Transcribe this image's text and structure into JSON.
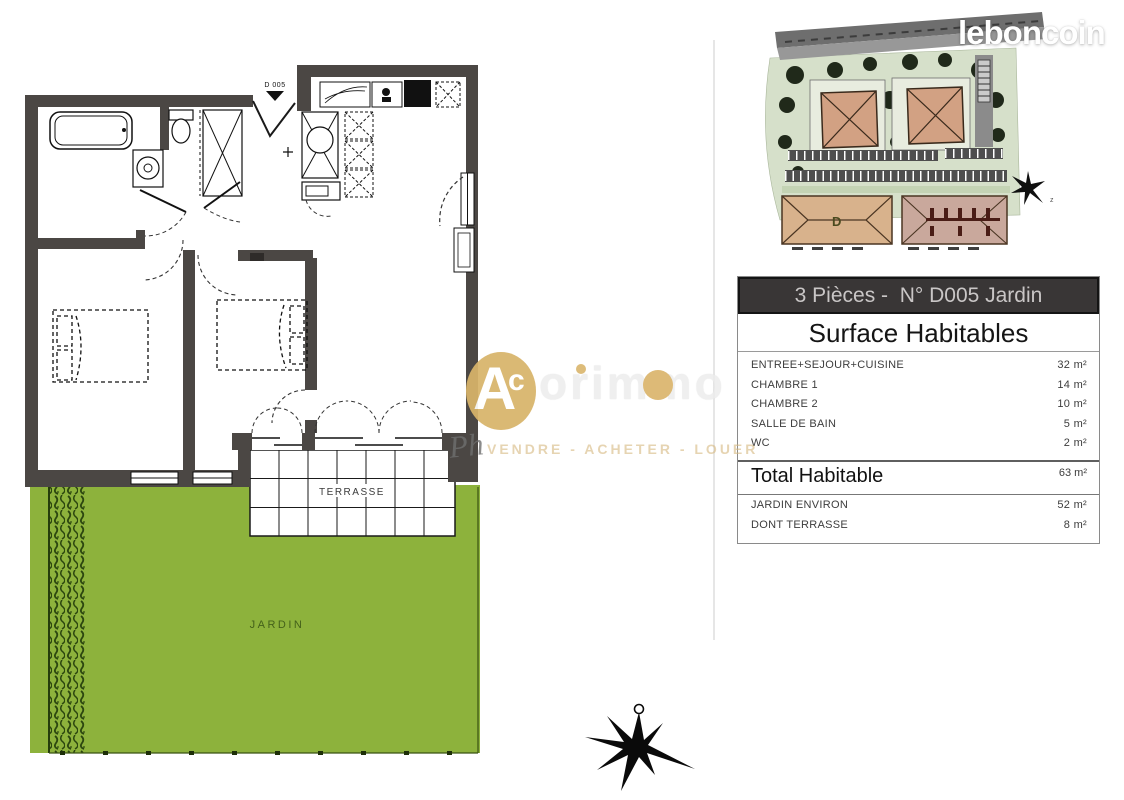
{
  "brand": {
    "logo": "leboncoin"
  },
  "floor_plan": {
    "entry_label": "D 005",
    "terrace_label": "TERRASSE",
    "garden_label": "JARDIN"
  },
  "site_plan": {
    "building_label": "D",
    "compass_label": "z"
  },
  "watermark": {
    "monogram_a": "A",
    "monogram_c": "c",
    "name_rest": "orimmo",
    "script": "Ph",
    "tagline": "VENDRE - ACHETER - LOUER"
  },
  "info_table": {
    "title": "3 Pièces -  N° D005 Jardin",
    "subtitle": "Surface Habitables",
    "rows": [
      {
        "label": "ENTREE+SEJOUR+CUISINE",
        "value": "32 m²"
      },
      {
        "label": "CHAMBRE 1",
        "value": "14 m²"
      },
      {
        "label": "CHAMBRE 2",
        "value": "10 m²"
      },
      {
        "label": "SALLE DE BAIN",
        "value": "5 m²"
      },
      {
        "label": "WC",
        "value": "2 m²"
      }
    ],
    "total": {
      "label": "Total Habitable",
      "value": "63 m²"
    },
    "extras": [
      {
        "label": "JARDIN ENVIRON",
        "value": "52 m²"
      },
      {
        "label": "DONT TERRASSE",
        "value": "8 m²"
      }
    ]
  },
  "colors": {
    "wall": "#4b4744",
    "garden_green": "#8db23c",
    "hedge_green": "#2c470f",
    "table_header_bg": "#393636",
    "roof_tan": "#d2a183",
    "roof_mauve": "#c9a89c",
    "site_ground": "#d6e0ca",
    "accent_gold": "#d8b46a"
  }
}
